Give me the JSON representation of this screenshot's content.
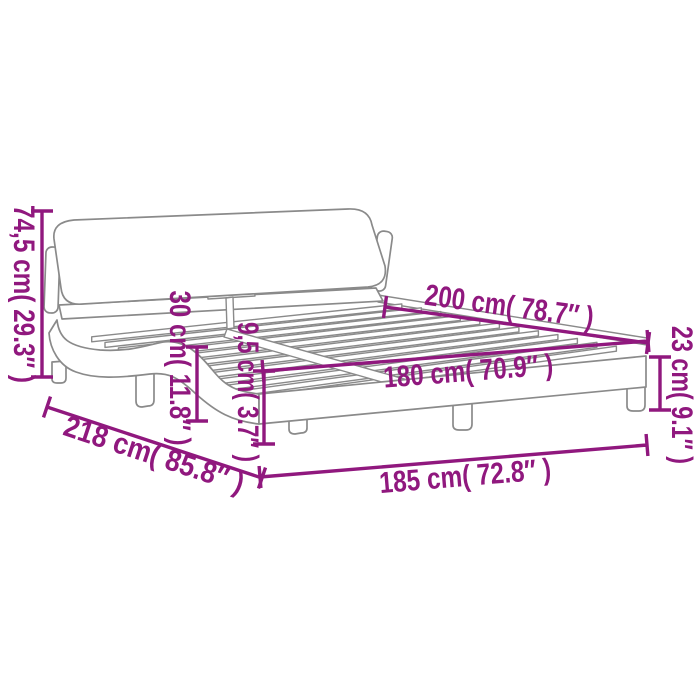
{
  "diagram": {
    "type": "product-dimension-diagram",
    "subject": "upholstered bed frame with headboard, slatted base and wave-shaped side rails",
    "accent_color": "#90187e",
    "drawing_line_color": "#8a8a8a",
    "background_color": "#ffffff",
    "dimensions": [
      {
        "id": "total-height",
        "label": "74,5 cm( 29.3″ )",
        "value_cm": "74,5",
        "value_in": "29.3",
        "orientation": "vertical-left"
      },
      {
        "id": "headboard-height",
        "label": "30 cm( 11.8″ )",
        "value_cm": "30",
        "value_in": "11.8",
        "orientation": "vertical"
      },
      {
        "id": "side-rail-height",
        "label": "9,5 cm( 3.7″ )",
        "value_cm": "9,5",
        "value_in": "3.7",
        "orientation": "vertical"
      },
      {
        "id": "inner-length",
        "label": "200 cm( 78.7″ )",
        "value_cm": "200",
        "value_in": "78.7",
        "orientation": "diagonal-top"
      },
      {
        "id": "inner-width",
        "label": "180 cm( 70.9″ )",
        "value_cm": "180",
        "value_in": "70.9",
        "orientation": "diagonal"
      },
      {
        "id": "frame-side-height",
        "label": "23 cm( 9.1″ )",
        "value_cm": "23",
        "value_in": "9.1",
        "orientation": "vertical-right"
      },
      {
        "id": "total-length",
        "label": "218 cm( 85.8″ )",
        "value_cm": "218",
        "value_in": "85.8",
        "orientation": "diagonal-left"
      },
      {
        "id": "total-width",
        "label": "185 cm( 72.8″ )",
        "value_cm": "185",
        "value_in": "72.8",
        "orientation": "diagonal-bottom"
      }
    ]
  }
}
